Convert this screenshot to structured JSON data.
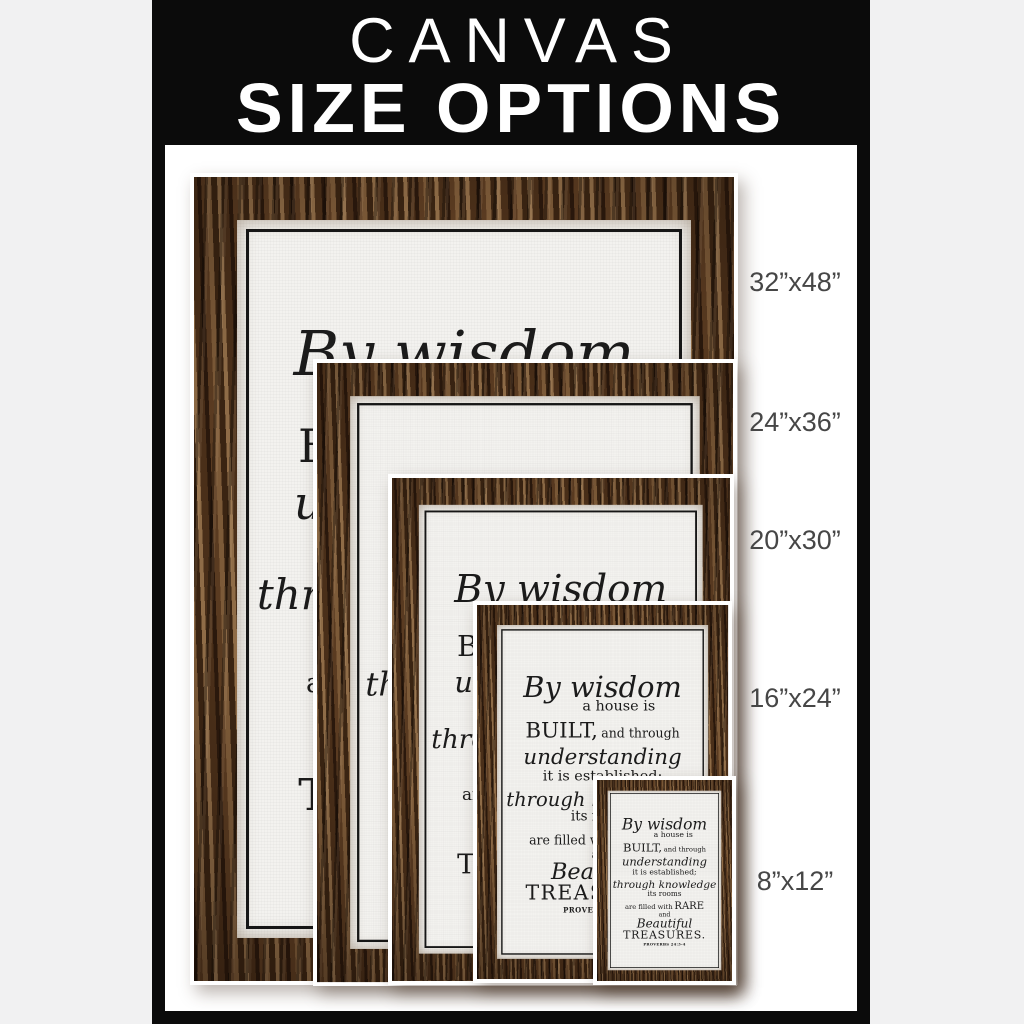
{
  "header": {
    "line1": "CANVAS",
    "line2": "SIZE OPTIONS"
  },
  "sizes": [
    {
      "id": "32x48",
      "label": "32”x48”"
    },
    {
      "id": "24x36",
      "label": "24”x36”"
    },
    {
      "id": "20x30",
      "label": "20”x30”"
    },
    {
      "id": "16x24",
      "label": "16”x24”"
    },
    {
      "id": "8x12",
      "label": "8”x12”"
    }
  ],
  "artwork": {
    "title": "By wisdom a house is built - Proverbs 24:3-4 canvas",
    "lines": [
      {
        "style": "ln1 ln-script",
        "segments": [
          {
            "text": "By wisdom"
          }
        ]
      },
      {
        "style": "ln2",
        "segments": [
          {
            "text": "a house is"
          }
        ]
      },
      {
        "style": "ln3",
        "segments": [
          {
            "text": "BUILT,",
            "style": "seg-built"
          },
          {
            "text": "and through",
            "style": "seg-mid"
          }
        ]
      },
      {
        "style": "ln4 ln-script",
        "segments": [
          {
            "text": "understanding"
          }
        ]
      },
      {
        "style": "ln5",
        "segments": [
          {
            "text": "it is established;"
          }
        ]
      },
      {
        "style": "ln6 ln-script",
        "segments": [
          {
            "text": "through knowledge"
          }
        ]
      },
      {
        "style": "ln7",
        "segments": [
          {
            "text": "its rooms"
          }
        ]
      },
      {
        "style": "ln8",
        "segments": [
          {
            "text": "are filled with",
            "style": "seg-mid"
          },
          {
            "text": "RARE",
            "style": "seg-rare"
          }
        ]
      },
      {
        "style": "ln9",
        "segments": [
          {
            "text": "and"
          }
        ]
      },
      {
        "style": "ln10 ln-script",
        "segments": [
          {
            "text": "Beautiful"
          }
        ]
      },
      {
        "style": "ln11",
        "segments": [
          {
            "text": "TREASURES."
          }
        ]
      },
      {
        "style": "ln12",
        "segments": [
          {
            "text": "PROVERBS 24:3-4"
          }
        ]
      }
    ]
  },
  "colors": {
    "page_background": "#f1f1f2",
    "panel_background": "#0b0b0b",
    "header_text": "#ffffff",
    "stage_background": "#ffffff",
    "wood_dark": "#2a180c",
    "wood_light": "#8f6c47",
    "canvas_face": "#f3f2ef",
    "verse_text": "#1b1b1b",
    "label_text": "#464646"
  }
}
